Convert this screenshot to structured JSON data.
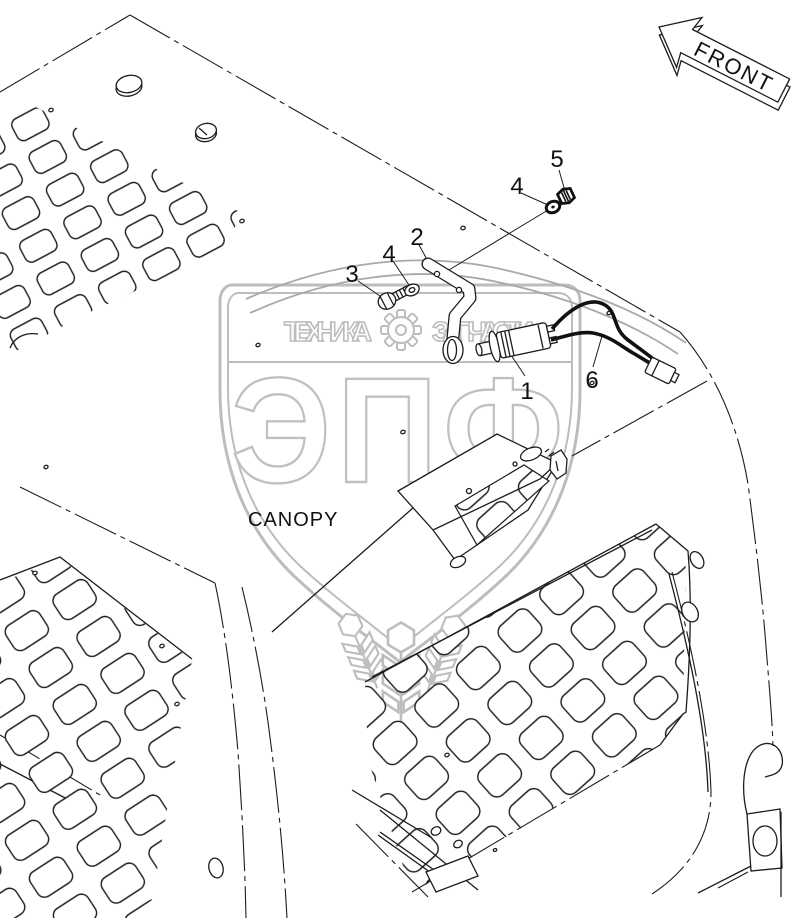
{
  "diagram": {
    "front_label": "FRONT",
    "canopy_label": "CANOPY",
    "callouts": {
      "socket": "1",
      "bracket": "2",
      "bolt": "3",
      "washer_front": "4",
      "washer_rear": "4",
      "nut": "5",
      "wire_harness": "6"
    }
  },
  "watermark": {
    "brand": "ЭПФ",
    "tagline_left": "ТЕХНИКА",
    "tagline_right": "ЗАПЧАСТИ"
  },
  "colors": {
    "line": "#1c1c1c",
    "watermark_gray": "#bdbdbd",
    "background": "#ffffff"
  }
}
